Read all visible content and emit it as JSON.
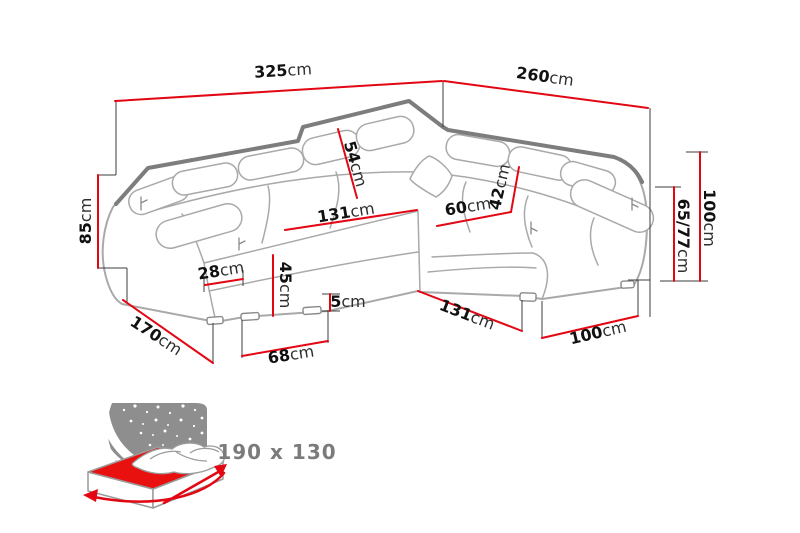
{
  "diagram": {
    "type": "furniture-dimension-diagram",
    "subject": "corner-sofa-with-measurements",
    "colors": {
      "dimension_line_red": "#e30613",
      "sofa_outline_gray": "#a9a9a9",
      "sofa_back_edge_gray": "#7d7d7d",
      "extension_line_black": "#3c3c3c",
      "label_text_black": "#1a1a1a",
      "caption_gray": "#7b7b7b",
      "bed_panel_gray": "#8e8e8e",
      "mattress_red": "#e8110f",
      "background": "#ffffff"
    }
  },
  "dims": {
    "d325": {
      "value": "325",
      "unit": "cm"
    },
    "d260": {
      "value": "260",
      "unit": "cm"
    },
    "d85": {
      "value": "85",
      "unit": "cm"
    },
    "d54": {
      "value": "54",
      "unit": "cm"
    },
    "d131seat": {
      "value": "131",
      "unit": "cm"
    },
    "d60": {
      "value": "60",
      "unit": "cm"
    },
    "d42": {
      "value": "42",
      "unit": "cm"
    },
    "d100right": {
      "value": "100",
      "unit": "cm"
    },
    "d6577": {
      "value": "65/77",
      "unit": "cm"
    },
    "d28": {
      "value": "28",
      "unit": "cm"
    },
    "d45": {
      "value": "45",
      "unit": "cm"
    },
    "d5": {
      "value": "5",
      "unit": "cm"
    },
    "d170": {
      "value": "170",
      "unit": "cm"
    },
    "d68": {
      "value": "68",
      "unit": "cm"
    },
    "d131bottom": {
      "value": "131",
      "unit": "cm"
    },
    "d100bottom": {
      "value": "100",
      "unit": "cm"
    }
  },
  "bed": {
    "icon": "fold-out-sleeping-function-icon",
    "size_label": "190 x 130"
  }
}
